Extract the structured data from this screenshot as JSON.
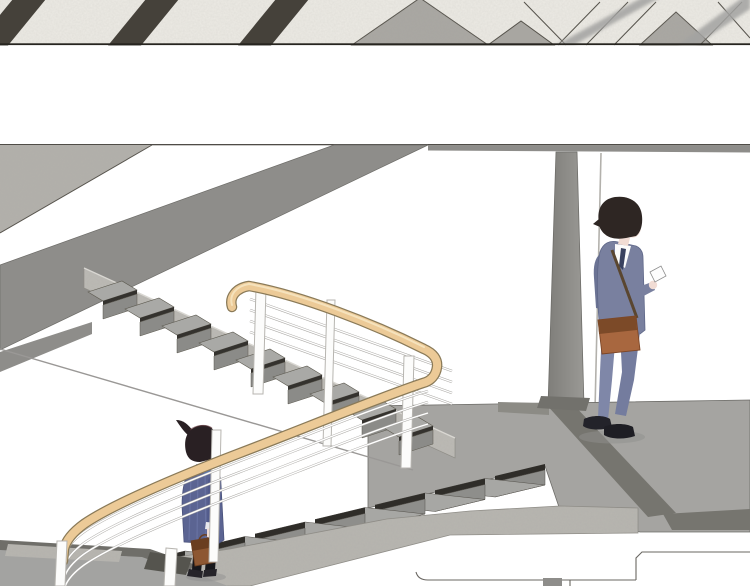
{
  "meta": {
    "title": "Stairwell comic page",
    "description": "Webtoon panel of an office stairwell: a woman with a ponytail carrying a brown handbag walks down a staircase with a wooden handrail and white cable railing, while a young man in a blue-gray suit with a brown shoulder bag leans against a white wall beside a concrete pillar, looking down at his smartphone. A narrow strip panel above shows a patterned tile floor."
  },
  "panels": [
    {
      "id": "top",
      "name": "tile-floor-strip",
      "content": "diagonal dark stripes and gray marble diamond tiles on light stone floor, blurred railing bars in foreground"
    },
    {
      "id": "gap",
      "name": "panel-gutter",
      "content": "blank white gutter between panels"
    },
    {
      "id": "main",
      "name": "stairwell-scene",
      "content": "two stair flights, wooden handrail with cable railing, mid-level floor, landing, pillar, two figures"
    }
  ],
  "scene": {
    "figures": [
      {
        "id": "man",
        "label": "man-checking-phone",
        "pose": "leaning against wall looking down at smartphone",
        "items": [
          "smartphone",
          "brown shoulder bag"
        ],
        "outfit": "blue-gray suit, white shirt, dark tie, dark shoes, face mask"
      },
      {
        "id": "woman",
        "label": "woman-on-stairs",
        "pose": "standing on lower stair flight carrying handbag",
        "items": [
          "brown handbag",
          "blue neckerchief"
        ],
        "outfit": "striped blue cardigan, black tights, dark shoes, high ponytail"
      }
    ],
    "objects": [
      "upper stair flight",
      "lower stair flight",
      "wooden handrail",
      "cable railing",
      "white railing posts",
      "concrete support pillar",
      "marble slab edge",
      "mid-level floor with dark trim",
      "stair landing",
      "next panel outline"
    ],
    "stairs": {
      "upper_flight_steps": 9,
      "lower_flight_steps": 8,
      "cables_per_rail": 4
    }
  },
  "colors": {
    "paper": "#ffffff",
    "ink": "#26241f",
    "panel_line": "#4f4c47",
    "tile_base": "#edebe5",
    "tile_stripe": "#45413a",
    "tile_marble": "#a8a6a1",
    "tile_outline": "#55524b",
    "marble_slab": "#b2b0ab",
    "slab_gray": "#8e8d8a",
    "ceiling": "#8e8d8a",
    "stringer": "#bcbab5",
    "tread_u": "#a9a9a6",
    "riser_u": "#8b8b88",
    "nosing_u": "#34322e",
    "tread_l": "#a7a7a4",
    "riser_l": "#8e8e8b",
    "nosing_l": "#2f2d29",
    "floor": "#a5a4a1",
    "floor_trim": "#76756f",
    "floor_edge": "#6e6d69",
    "landing": "#a3a3a1",
    "landing_trim": "#6f6e69",
    "concrete": "#b7b5b0",
    "wood": "#ecca97",
    "wood_edge": "#8a7a58",
    "wood_hi": "#f6e4c0",
    "cable": "#a8a6a2",
    "cable_hi": "#ffffff",
    "post": "#fcfcfb",
    "post_edge": "#b7b5b0",
    "pillar_l": "#7f7e7a",
    "pillar_r": "#9a9995",
    "wall_line": "#b3b1ac",
    "man_hair": "#2e2623",
    "man_suit": "#79809f",
    "man_suit_dk": "#6b7394",
    "man_pants": "#7f87a8",
    "man_pants_dk": "#747c9e",
    "man_shoe": "#23232a",
    "man_bag": "#a8673f",
    "man_bag_dk": "#7c4a28",
    "strap": "#5a4630",
    "shirt": "#fbfbfb",
    "tie": "#39415f",
    "skin": "#f1dcd4",
    "mask": "#eef2f5",
    "woman_hair": "#292023",
    "cardigan": "#5b6492",
    "cardigan_dk": "#525b8c",
    "stripe": "#6c76a6",
    "scarf": "#5574b8",
    "tights": "#17171b",
    "woman_shoe": "#26242a",
    "woman_bag": "#8d5732",
    "woman_bag_dk": "#6a3e20",
    "cuff": "#e8e8ec",
    "shadow": "#8f8f8d"
  }
}
